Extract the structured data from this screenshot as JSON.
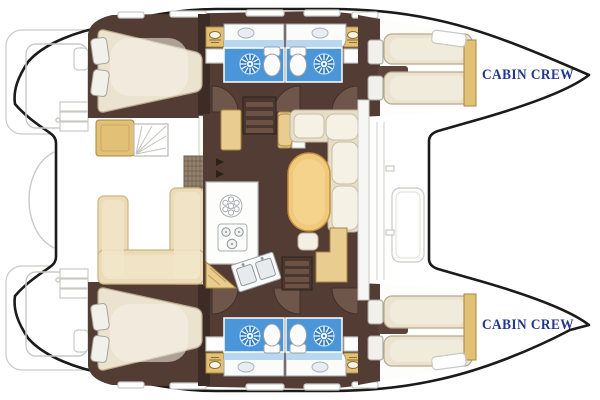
{
  "window": {
    "width": 600,
    "height": 400
  },
  "diagram": {
    "type": "boat-floorplan",
    "vessel": "catamaran-layout-top-view",
    "labels": {
      "bow_top": "CABIN CREW",
      "bow_bottom": "CABIN CREW"
    },
    "icons": {
      "shower": "sun-rays-icon",
      "toilet": "toilet-icon",
      "sink": "double-sink-icon",
      "stove": "three-burner-stove-icon",
      "stairs": "companionway-steps-icon"
    },
    "palette": {
      "outline": "#1b1b1b",
      "floor": "#523c34",
      "floor-dark": "#3d2c25",
      "door": "#6f564a",
      "door-edge": "#41302a",
      "bed": "#ebe3d0",
      "bed-edge": "#b7a98c",
      "bed-highlight": "#f7f3e8",
      "pillow": "#f1f0ea",
      "settee": "#e6dec9",
      "cushion": "#f5f1e5",
      "gold": "#e2c075",
      "gold-light": "#e9cd90",
      "gold-edge": "#a8863f",
      "table": "#f0c97b",
      "table-edge": "#c3903d",
      "tile": "#4a96d8",
      "tile-light": "#b9d7ee",
      "shower-blue": "#2e7bc2",
      "fixture": "#fbfbf9",
      "fixture-edge": "#9aa4aa",
      "bench": "#ecdbb7",
      "bench-edge": "#cdb37f",
      "deck-line": "#c9c9c6",
      "navy": "#22368e"
    }
  }
}
